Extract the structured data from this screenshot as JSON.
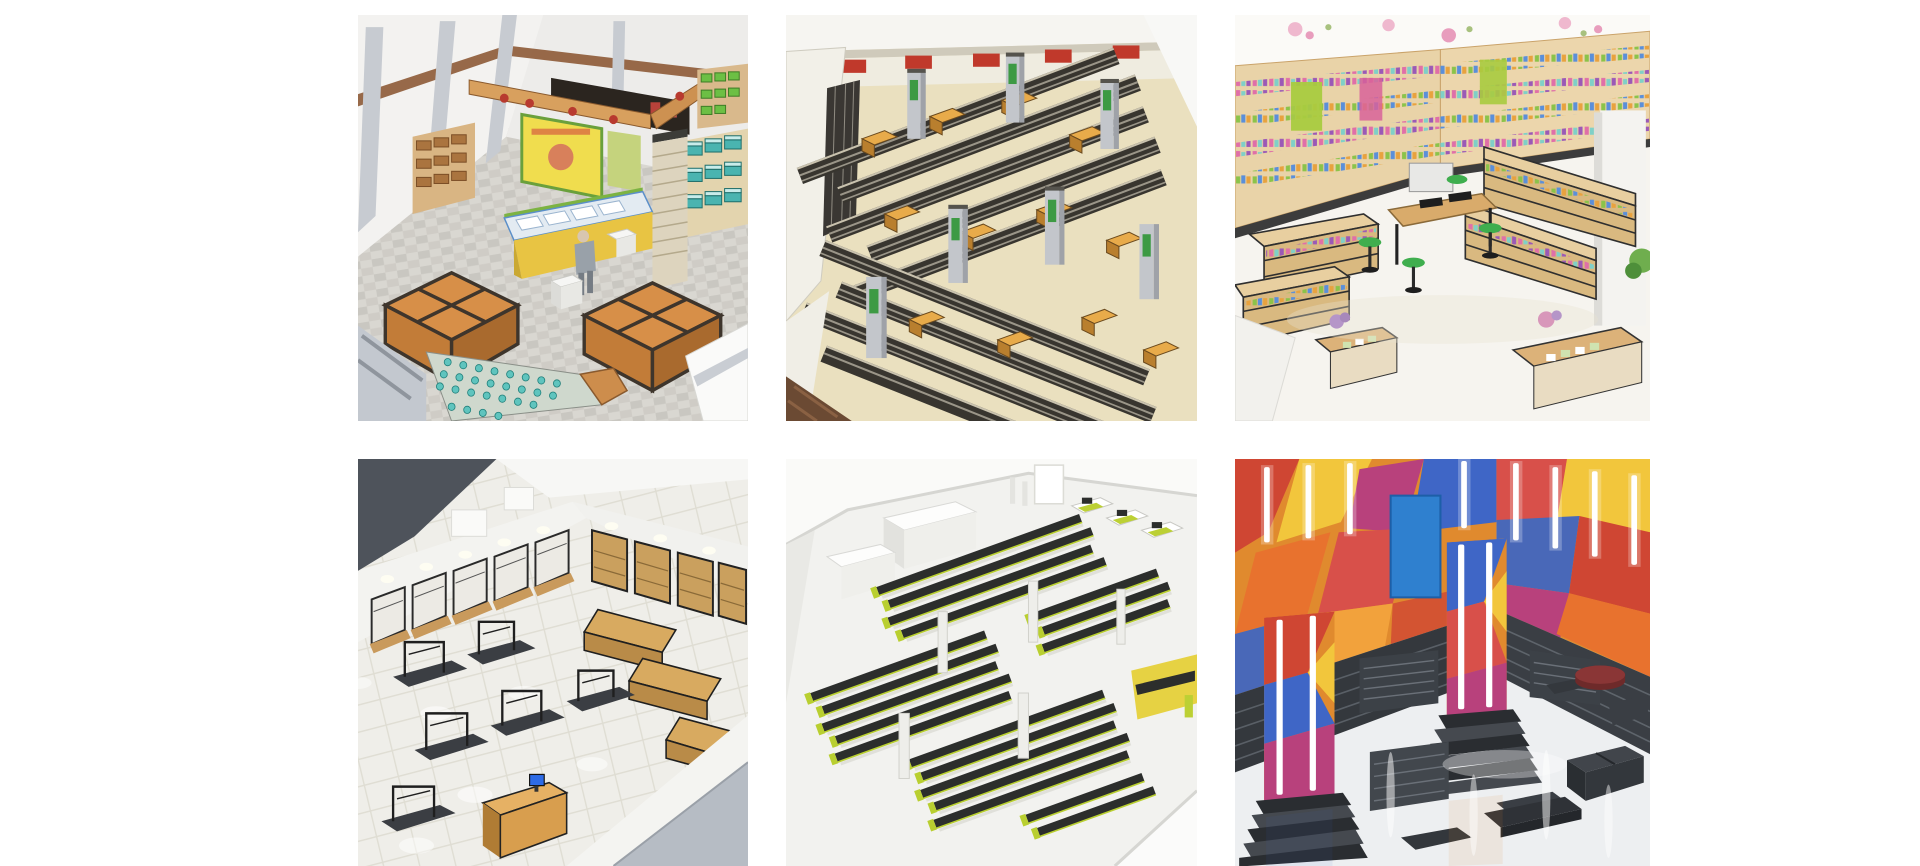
{
  "page": {
    "background_color": "#ffffff",
    "type": "image-gallery",
    "grid": {
      "rows": 2,
      "columns": 3
    }
  },
  "gallery": {
    "items": [
      {
        "id": "sketchup-supermarket-corner",
        "alt": "SketchUp 3D model of a supermarket corner: orange wooden produce bins, yellow deli counter with white trays, teal and green crate shelving, hanging wooden beam with red ribbons, yellow poster and a shopper on a gray checkered floor",
        "dominant_colors": [
          "#d78f48",
          "#4ab4b0",
          "#e8c443",
          "#d9d7d1"
        ]
      },
      {
        "id": "sketchup-supermarket-aisles",
        "alt": "SketchUp 3D overview of a store densely packed with rows of dark slatted shelving, orange promotion tables, gray pillars with green signs and red signs along the top wall, on a cream floor",
        "dominant_colors": [
          "#38352f",
          "#e0a23e",
          "#eae0bf",
          "#c0392b"
        ]
      },
      {
        "id": "cosmetics-store-render",
        "alt": "Photorealistic render of a bright cosmetics store: wood-and-black wall shelving filled with colorful products, center bar table with green stools, gondola shelves, plants and flower display tables on a glossy white floor",
        "dominant_colors": [
          "#e9d3a8",
          "#3fae4e",
          "#e06fa8",
          "#f6f4ef"
        ]
      },
      {
        "id": "clothing-store-render",
        "alt": "Photorealistic render of a clothing store: black metal garment racks on a white tiled floor, wooden wall bays and gondola shelving, wooden cashier desk with a blue screen, spotlit white perimeter walls and a dark ceiling corner",
        "dominant_colors": [
          "#4e535b",
          "#d89e4e",
          "#efeee9",
          "#2e6be6"
        ]
      },
      {
        "id": "white-model-supermarket",
        "alt": "Clean white 3D model of a supermarket layout: long parallel rows of black shelving with lime-green end panels, white partition rooms, checkout stations with lime accents and a yellow feature wall",
        "dominant_colors": [
          "#2c2e2c",
          "#b9cf30",
          "#f2f2ef",
          "#e6d243"
        ]
      },
      {
        "id": "graffiti-fashion-store",
        "alt": "Render of a fashion store with graffiti-covered walls in orange, red, blue and yellow, vertical LED light strips, graffiti-wrapped columns with louvered black shelf bases, dark display tables, a round dark-red ottoman and a glossy reflective floor",
        "dominant_colors": [
          "#e08a2e",
          "#cf4633",
          "#3f66c6",
          "#34383d"
        ]
      }
    ]
  }
}
